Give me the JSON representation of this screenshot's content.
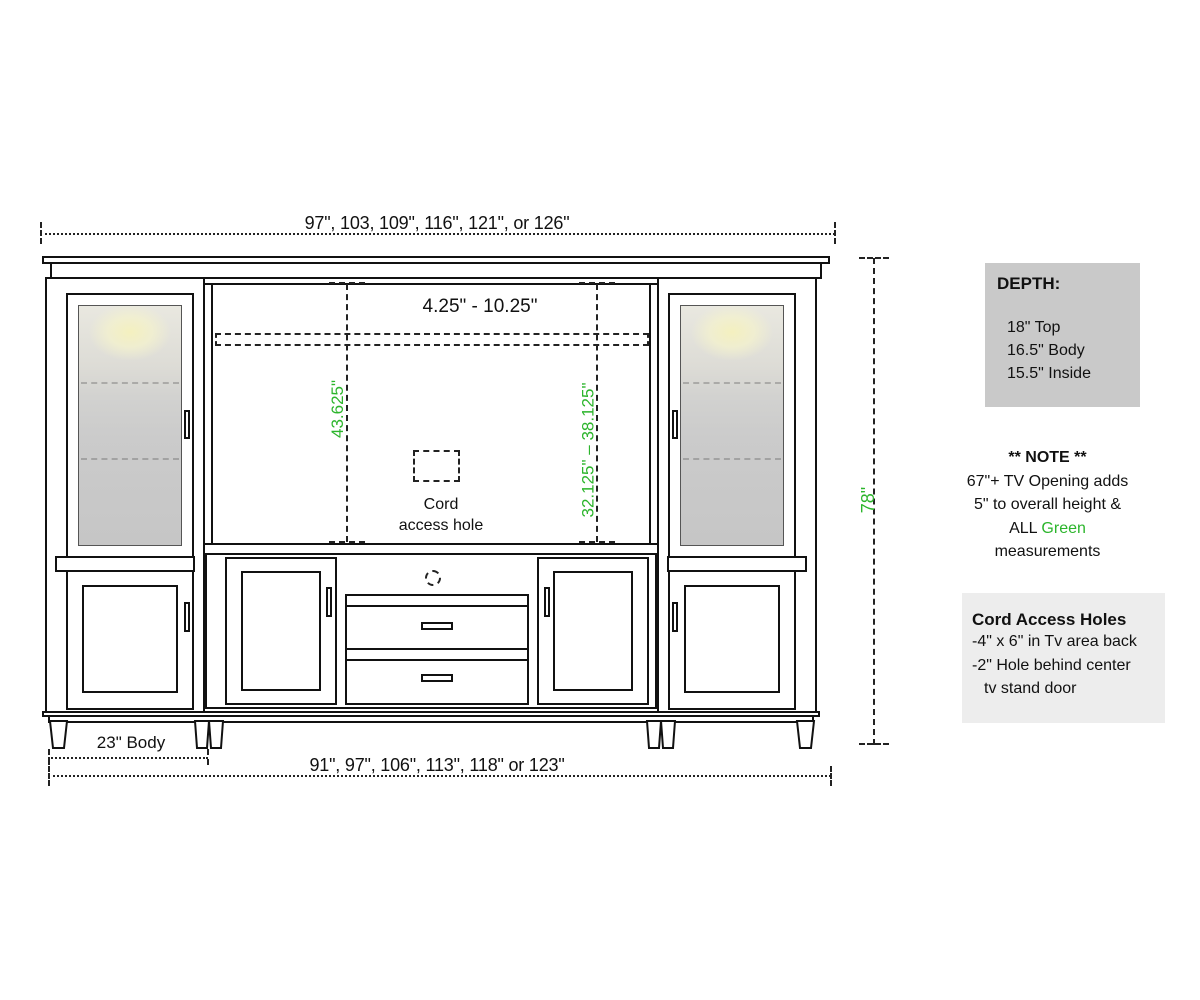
{
  "colors": {
    "green_measurement": "#2cb52c",
    "line": "#111111",
    "depth_box_bg": "#c9c9c9",
    "cord_box_bg": "#ededed",
    "glass_glow": "#f4f0bf"
  },
  "dimensions": {
    "top_width": "97\", 103, 109\", 116\", 121\", or 126\"",
    "bottom_width": "91\", 97\", 106\", 113\", 118\" or 123\"",
    "body_width": "23\" Body",
    "overall_height": "78\"",
    "tv_top_gap": "4.25\" - 10.25\"",
    "left_opening_height": "43.625\"",
    "right_opening_height": "32.125\" – 38.125\""
  },
  "cord_hole_label": {
    "line1": "Cord",
    "line2": "access hole"
  },
  "depth_panel": {
    "title": "DEPTH:",
    "items": [
      "18\" Top",
      "16.5\" Body",
      "15.5\" Inside"
    ]
  },
  "note_panel": {
    "title": "** NOTE **",
    "line1": "67\"+ TV Opening adds",
    "line2": "5\" to overall height &",
    "line3_prefix": "ALL ",
    "line3_highlight": "Green",
    "line4": "measurements"
  },
  "cord_panel": {
    "title": "Cord Access Holes",
    "line1": "-4\" x 6\" in Tv area back",
    "line2": "-2\" Hole behind center",
    "line3": "tv stand door"
  }
}
